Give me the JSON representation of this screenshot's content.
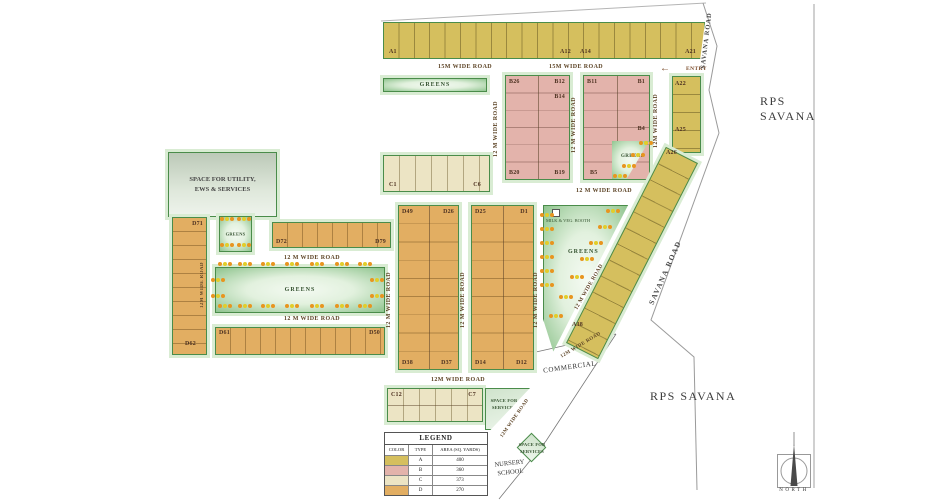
{
  "annotations": {
    "rps1": "RPS",
    "rps2": "SAVANA",
    "rps_bottom": "RPS SAVANA",
    "savana_road": "SAVANA ROAD",
    "entry": "ENTRY",
    "north": "NORTH"
  },
  "roads": {
    "wide15": "15M WIDE ROAD",
    "wide12": "12 M WIDE ROAD",
    "wide12c": "12M WIDE ROAD"
  },
  "areas": {
    "utility": "SPACE FOR UTILITY, EWS & SERVICES",
    "greens": "GREENS",
    "commercial": "COMMERCIAL",
    "nursery": "NURSERY SCHOOL",
    "services": "SPACE FOR SERVICES",
    "milk": "MILK & VEG. BOOTH"
  },
  "plots": {
    "a1": "A1",
    "a12": "A12",
    "a14": "A14",
    "a21": "A21",
    "a22": "A22",
    "a25": "A25",
    "a26": "A26",
    "a38": "A38",
    "b26": "B26",
    "b12": "B12",
    "b14": "B14",
    "b20": "B20",
    "b19": "B19",
    "b11": "B11",
    "b1": "B1",
    "b4": "B4",
    "b5": "B5",
    "c1": "C1",
    "c6": "C6",
    "c12": "C12",
    "c7": "C7",
    "d49": "D49",
    "d26": "D26",
    "d38": "D38",
    "d37": "D37",
    "d25": "D25",
    "d1": "D1",
    "d14": "D14",
    "d12": "D12",
    "d71": "D71",
    "d72": "D72",
    "d79": "D79",
    "d61": "D61",
    "d50": "D50",
    "d62": "D62"
  },
  "legend": {
    "title": "LEGEND",
    "columns": [
      "COLOR",
      "TYPE",
      "AREA (SQ. YARDS)"
    ],
    "rows": [
      {
        "type": "A",
        "area": "400",
        "color": "#d5bf5e"
      },
      {
        "type": "B",
        "area": "360",
        "color": "#e3b3ab"
      },
      {
        "type": "C",
        "area": "373",
        "color": "#ece4c4"
      },
      {
        "type": "D",
        "area": "270",
        "color": "#e2ae62"
      }
    ]
  },
  "colors": {
    "plot_a": "#d5bf5e",
    "plot_b": "#e3b3ab",
    "plot_c": "#ece4c4",
    "plot_d": "#e2ae62",
    "greens_border": "#4a8c4a",
    "road_text": "#5d4426"
  }
}
